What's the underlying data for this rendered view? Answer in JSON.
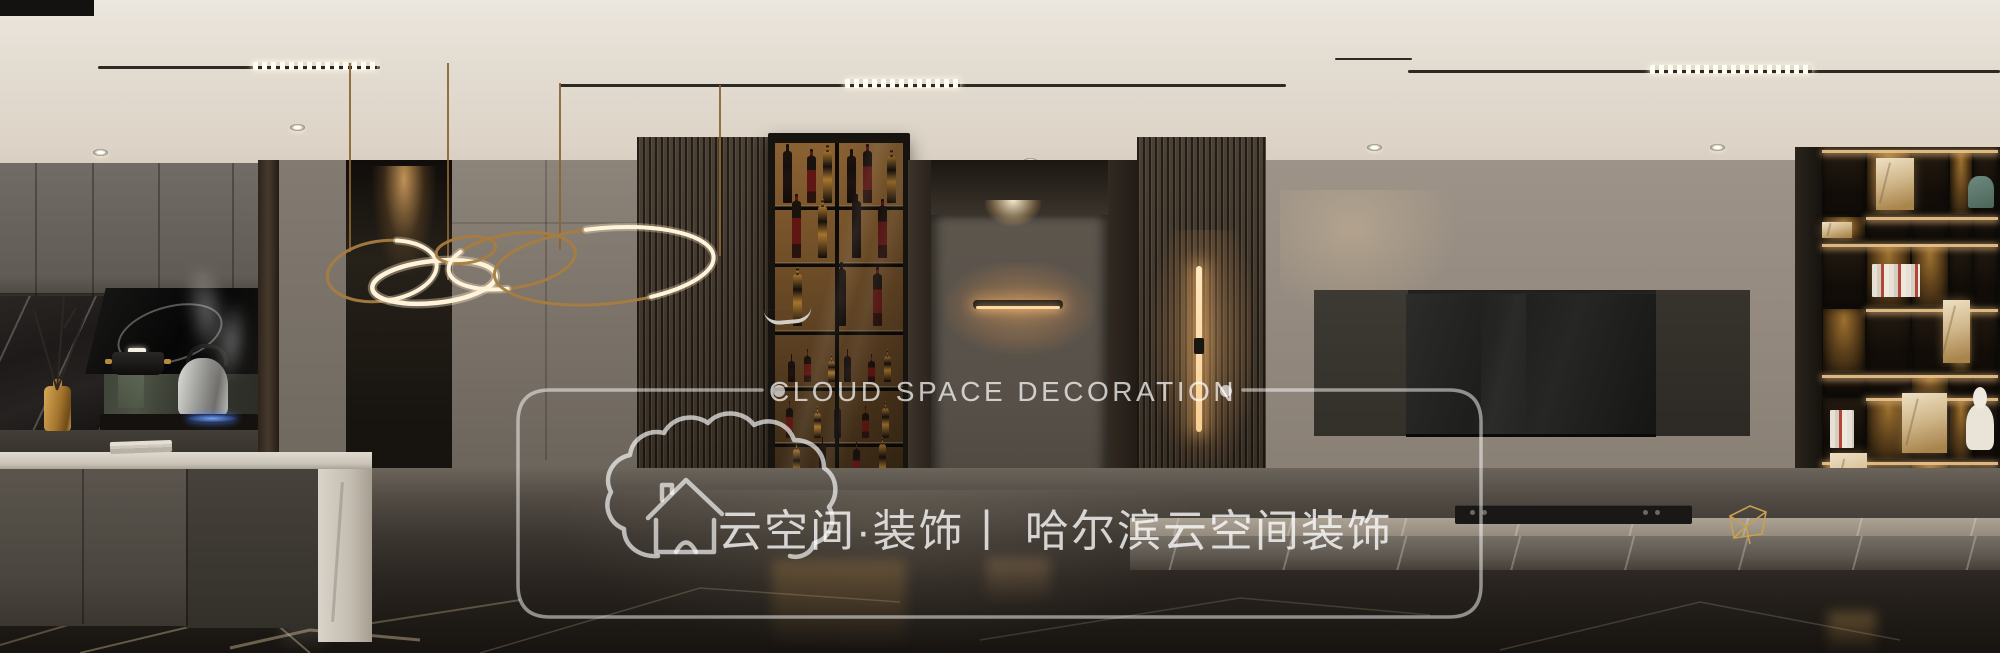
{
  "watermark": {
    "brand_en": "CLOUD SPACE DECORATION",
    "bullet": "•",
    "brand_cn": "云空间·装饰丨 哈尔滨云空间装饰",
    "logo": "cloud-house-logo",
    "color": "#ffffff"
  },
  "scene": {
    "palette": {
      "ceiling": "#ddd4c7",
      "wall_greige": "#948a7f",
      "wall_dining": "#7c746a",
      "slat_wood": "#3f352a",
      "cabinet_amber": "#77532a",
      "leather_rust": "#8d4734",
      "gold": "#b8894e",
      "marble_floor": "#29241f",
      "lamp_warm": "#ffd9a2"
    },
    "ceiling": {
      "tracks": [
        [
          98,
          66,
          282,
          3
        ],
        [
          560,
          84,
          726,
          3
        ],
        [
          1408,
          70,
          592,
          3
        ],
        [
          1335,
          58,
          77,
          2
        ]
      ],
      "dashes": [
        [
          253,
          62,
          124,
          8
        ],
        [
          845,
          79,
          115,
          9
        ],
        [
          1650,
          65,
          162,
          9
        ]
      ],
      "spots": [
        [
          100,
          152
        ],
        [
          297,
          127
        ],
        [
          665,
          158
        ],
        [
          856,
          161
        ],
        [
          1030,
          161
        ],
        [
          1210,
          146
        ],
        [
          1374,
          147
        ],
        [
          1717,
          147
        ]
      ]
    },
    "wine_rows": [
      {
        "bottom": 203,
        "n": 6,
        "h": 52
      },
      {
        "bottom": 258,
        "n": 4,
        "h": 60
      },
      {
        "bottom": 326,
        "n": 3,
        "h": 58
      },
      {
        "bottom": 382,
        "n": 6,
        "h": 30
      },
      {
        "bottom": 438,
        "n": 5,
        "h": 32
      },
      {
        "bottom": 488,
        "n": 4,
        "h": 44
      },
      {
        "bottom": 536,
        "n": 3,
        "h": 38
      }
    ],
    "wine_shelf_lines": [
      205,
      262,
      330,
      386,
      442,
      492
    ],
    "bottle_colors": [
      "#1f1310",
      "#571a14",
      "#a5742e"
    ],
    "chairs": [
      {
        "x": 166,
        "y": 436,
        "w": 122,
        "h": 216,
        "far": 0
      },
      {
        "x": 386,
        "y": 442,
        "w": 108,
        "h": 208,
        "far": 0
      },
      {
        "x": 518,
        "y": 436,
        "w": 112,
        "h": 217,
        "far": 0
      },
      {
        "x": 724,
        "y": 432,
        "w": 80,
        "h": 188,
        "far": 0
      },
      {
        "x": 352,
        "y": 423,
        "w": 84,
        "h": 95,
        "far": 1
      },
      {
        "x": 556,
        "y": 424,
        "w": 74,
        "h": 55,
        "far": 1
      },
      {
        "x": 642,
        "y": 425,
        "w": 72,
        "h": 80,
        "far": 1
      }
    ],
    "bookshelf": {
      "left": 1822,
      "right": 1998,
      "row_lines": [
        147,
        214,
        241,
        306,
        372,
        395,
        459,
        524
      ],
      "col_lines": [
        1822,
        1866,
        1911,
        1949,
        1973,
        1998
      ],
      "glow_cells": [
        [
          0,
          1
        ],
        [
          0,
          3
        ],
        [
          1,
          0
        ],
        [
          2,
          1
        ],
        [
          2,
          2
        ],
        [
          3,
          0
        ],
        [
          3,
          3
        ],
        [
          4,
          2
        ],
        [
          5,
          1
        ],
        [
          5,
          3
        ],
        [
          6,
          0
        ],
        [
          6,
          2
        ]
      ],
      "items": [
        {
          "t": "marble",
          "x": 1902,
          "y": 393,
          "w": 45,
          "h": 60
        },
        {
          "t": "marble",
          "x": 1943,
          "y": 300,
          "w": 27,
          "h": 63
        },
        {
          "t": "marble",
          "x": 1830,
          "y": 453,
          "w": 37,
          "h": 66
        },
        {
          "t": "marble",
          "x": 1876,
          "y": 158,
          "w": 38,
          "h": 52
        },
        {
          "t": "books",
          "x": 1830,
          "y": 410,
          "w": 24,
          "h": 38
        },
        {
          "t": "books",
          "x": 1872,
          "y": 264,
          "w": 48,
          "h": 33
        },
        {
          "t": "bust",
          "x": 1966,
          "y": 404,
          "w": 28,
          "h": 46
        },
        {
          "t": "art",
          "x": 1968,
          "y": 176,
          "w": 26,
          "h": 32
        },
        {
          "t": "marble",
          "x": 1822,
          "y": 222,
          "w": 30,
          "h": 16
        }
      ]
    },
    "console_knobs": [
      [
        1470,
        510
      ],
      [
        1482,
        510
      ],
      [
        1643,
        510
      ],
      [
        1655,
        510
      ]
    ],
    "chandelier": {
      "rods": [
        [
          350,
          63,
          252
        ],
        [
          448,
          63,
          280
        ],
        [
          560,
          83,
          250
        ],
        [
          720,
          85,
          256
        ]
      ],
      "rings": [
        {
          "cx": 382,
          "cy": 271,
          "rx": 55,
          "ry": 30,
          "rot": -8,
          "lit": "partial",
          "dash": "42 58",
          "off": 18
        },
        {
          "cx": 434,
          "cy": 282,
          "rx": 62,
          "ry": 21,
          "rot": -6,
          "lit": "full",
          "dash": "",
          "off": 0
        },
        {
          "cx": 466,
          "cy": 250,
          "rx": 30,
          "ry": 13,
          "rot": -8,
          "lit": "none",
          "dash": "",
          "off": 0
        },
        {
          "cx": 512,
          "cy": 261,
          "rx": 64,
          "ry": 27,
          "rot": -9,
          "lit": "partial",
          "dash": "30 70",
          "off": 72
        },
        {
          "cx": 604,
          "cy": 266,
          "rx": 110,
          "ry": 38,
          "rot": -5,
          "lit": "partial",
          "dash": "44 56",
          "off": 28
        }
      ]
    },
    "floor_veins": [
      {
        "pts": "0,645 160,598 360,625 520,600",
        "o": 0.3,
        "w": 2
      },
      {
        "pts": "80,653 260,610 310,653",
        "o": 0.38,
        "w": 2
      },
      {
        "pts": "480,653 700,588 900,602",
        "o": 0.22,
        "w": 1.5
      },
      {
        "pts": "980,640 1240,598 1430,615",
        "o": 0.18,
        "w": 1.5
      },
      {
        "pts": "1500,650 1700,602 1900,640",
        "o": 0.2,
        "w": 1.5
      },
      {
        "pts": "230,648 310,630 420,640",
        "o": 0.42,
        "w": 3
      }
    ]
  }
}
